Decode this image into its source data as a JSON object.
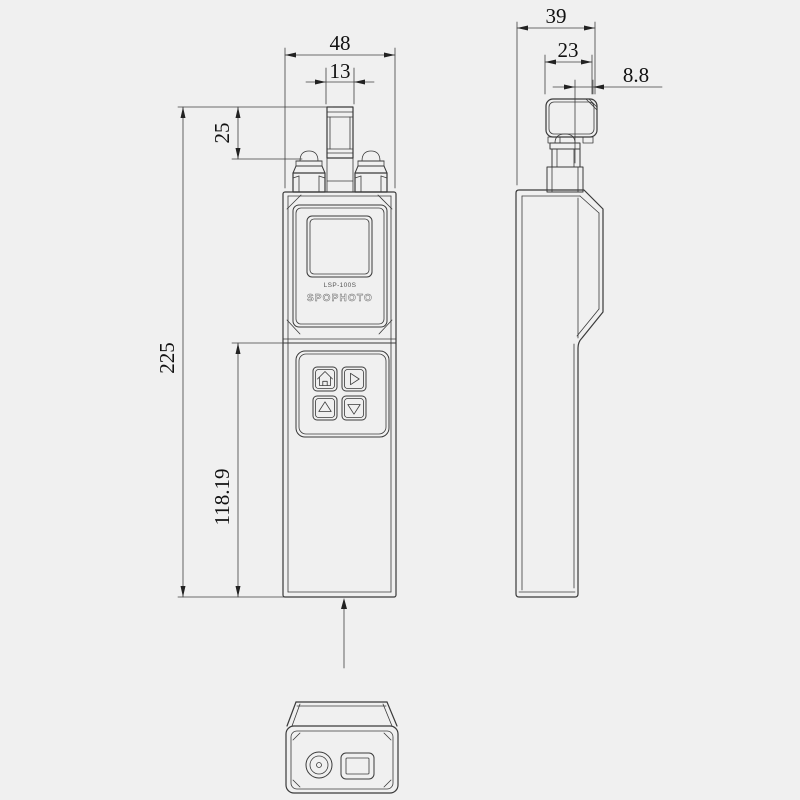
{
  "drawing": {
    "device": {
      "model": "LSP-100S",
      "brand": "SPOPHOTO"
    },
    "front_view": {
      "dim_overall_width": "48",
      "dim_connector_width": "13",
      "dim_connector_height": "25",
      "dim_overall_height": "225",
      "dim_body_height": "118.19"
    },
    "side_view": {
      "dim_head_depth": "39",
      "dim_body_depth": "23",
      "dim_cap_depth": "8.8"
    },
    "buttons": [
      "home",
      "right",
      "up",
      "down"
    ],
    "icons": {
      "home": "home-icon",
      "right": "arrow-right-icon",
      "up": "arrow-up-icon",
      "down": "arrow-down-icon"
    },
    "colors": {
      "background": "#f0f0f0",
      "line": "#3a3a3a",
      "text": "#111111"
    }
  }
}
